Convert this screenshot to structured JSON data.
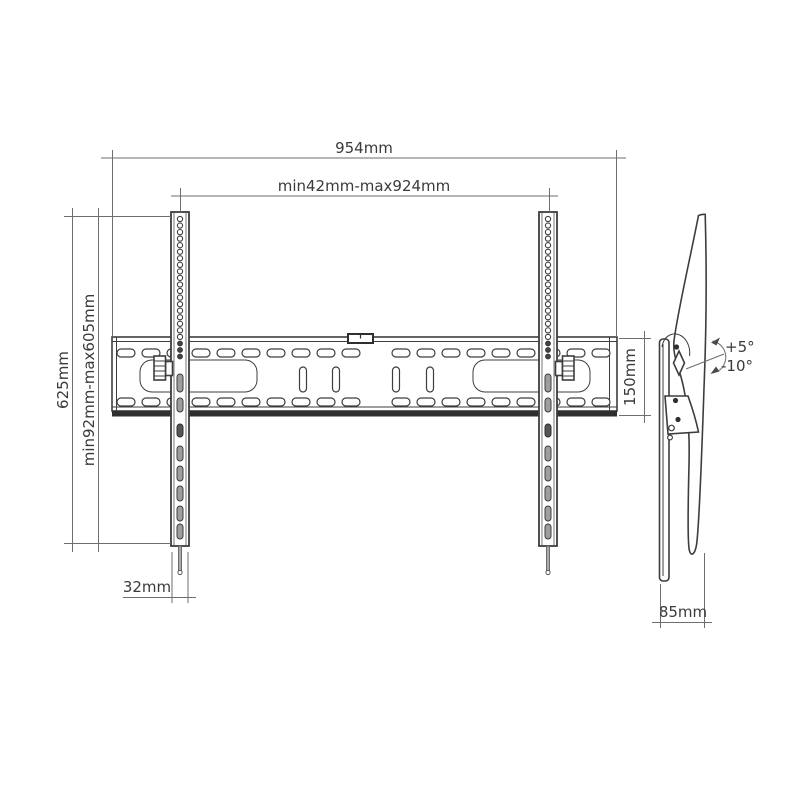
{
  "drawing": {
    "type": "tv-wall-mount-technical-drawing",
    "views": [
      "front",
      "side"
    ]
  },
  "dimensions": {
    "overall_width": "954mm",
    "hole_pattern_width": "min42mm-max924mm",
    "overall_height": "625mm",
    "hole_pattern_height": "min92mm-max605mm",
    "plate_height": "150mm",
    "rail_width": "32mm",
    "profile_depth": "85mm"
  },
  "tilt": {
    "up": "+5°",
    "down": "-10°"
  },
  "colors": {
    "outline": "#3d3d3d",
    "dimension_line": "#6e6e6e",
    "text": "#3a3a3a",
    "background": "#ffffff",
    "slot_fill": "#9e9e9e",
    "flange_dark": "#2f2f2f"
  }
}
